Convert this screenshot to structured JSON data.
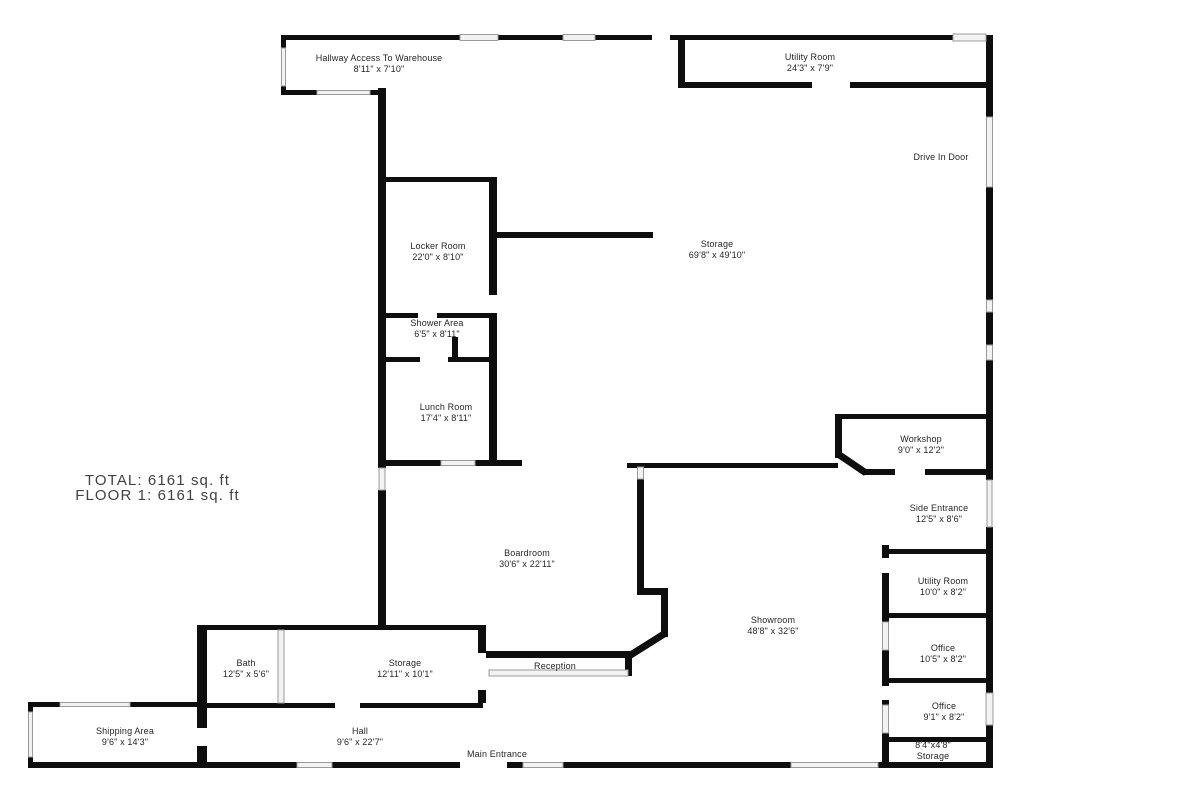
{
  "summary": {
    "total": "TOTAL: 6161 sq. ft",
    "floor1": "FLOOR 1: 6161 sq. ft"
  },
  "rooms": [
    {
      "id": "hallway-access-to-warehouse",
      "line1": "Hallway Access To Warehouse",
      "line2": "8'11\" x 7'10\""
    },
    {
      "id": "utility-room-top",
      "line1": "Utility Room",
      "line2": "24'3\" x 7'9\""
    },
    {
      "id": "locker-room",
      "line1": "Locker Room",
      "line2": "22'0\" x 8'10\""
    },
    {
      "id": "storage-main",
      "line1": "Storage",
      "line2": "69'8\" x 49'10\""
    },
    {
      "id": "shower-area",
      "line1": "Shower Area",
      "line2": "6'5\" x 8'11\""
    },
    {
      "id": "lunch-room",
      "line1": "Lunch Room",
      "line2": "17'4\" x 8'11\""
    },
    {
      "id": "workshop",
      "line1": "Workshop",
      "line2": "9'0\" x 12'2\""
    },
    {
      "id": "side-entrance",
      "line1": "Side Entrance",
      "line2": "12'5\" x 8'6\""
    },
    {
      "id": "boardroom",
      "line1": "Boardroom",
      "line2": "30'6\" x 22'11\""
    },
    {
      "id": "utility-room-right",
      "line1": "Utility Room",
      "line2": "10'0\" x 8'2\""
    },
    {
      "id": "showroom",
      "line1": "Showroom",
      "line2": "48'8\" x 32'6\""
    },
    {
      "id": "office-upper",
      "line1": "Office",
      "line2": "10'5\" x 8'2\""
    },
    {
      "id": "bath",
      "line1": "Bath",
      "line2": "12'5\" x 5'6\""
    },
    {
      "id": "storage-mid",
      "line1": "Storage",
      "line2": "12'11\" x 10'1\""
    },
    {
      "id": "office-lower",
      "line1": "Office",
      "line2": "9'1\" x 8'2\""
    },
    {
      "id": "shipping-area",
      "line1": "Shipping Area",
      "line2": "9'6\" x 14'3\""
    },
    {
      "id": "hall",
      "line1": "Hall",
      "line2": "9'6\" x 22'7\""
    },
    {
      "id": "storage-bottom-right",
      "line1": "8'4\"x4'8\"",
      "line2": "Storage"
    }
  ],
  "annotations": {
    "drive_in_door": "Drive In Door",
    "reception": "Reception",
    "main_entrance": "Main Entrance"
  },
  "colors": {
    "wall": "#0e0e0e",
    "window_fill": "#f2f2f2",
    "window_stroke": "#9a9a9a",
    "label_text": "#262626",
    "summary_text": "#414141"
  }
}
